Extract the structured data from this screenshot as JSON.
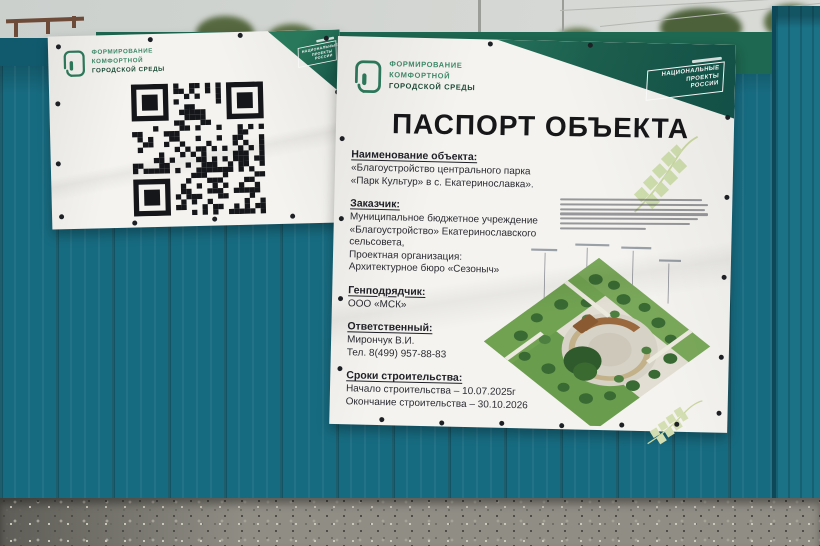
{
  "scene": {
    "description": "Photo of a teal construction fence with two white vinyl banners: a QR-code banner and an object passport banner for a park improvement project"
  },
  "fkgs_logo": {
    "line1": "ФОРМИРОВАНИЕ",
    "line2": "КОМФОРТНОЙ",
    "line3": "ГОРОДСКОЙ СРЕДЫ"
  },
  "national_projects_badge": {
    "line1": "НАЦИОНАЛЬНЫЕ",
    "line2": "ПРОЕКТЫ",
    "line3": "РОССИИ"
  },
  "passport_banner": {
    "title": "ПАСПОРТ ОБЪЕКТА",
    "sections": [
      {
        "heading": "Наименование объекта:",
        "lines": [
          "«Благоустройство центрального парка",
          "«Парк Культур» в с. Екатеринославка»."
        ]
      },
      {
        "heading": "Заказчик:",
        "lines": [
          "Муниципальное бюджетное учреждение",
          "«Благоустройство» Екатеринославского",
          "сельсовета,",
          "Проектная организация:",
          "Архитектурное бюро «Сезоныч»"
        ]
      },
      {
        "heading": "Генподрядчик:",
        "lines": [
          "ООО «МСК»"
        ]
      },
      {
        "heading": "Ответственный:",
        "lines": [
          "Мирончук В.И.",
          "Тел. 8(499) 957-88-83"
        ]
      },
      {
        "heading": "Сроки строительства:",
        "lines": [
          "Начало строительства – 10.07.2025г",
          "Окончание строительства – 30.10.2026"
        ]
      }
    ]
  }
}
